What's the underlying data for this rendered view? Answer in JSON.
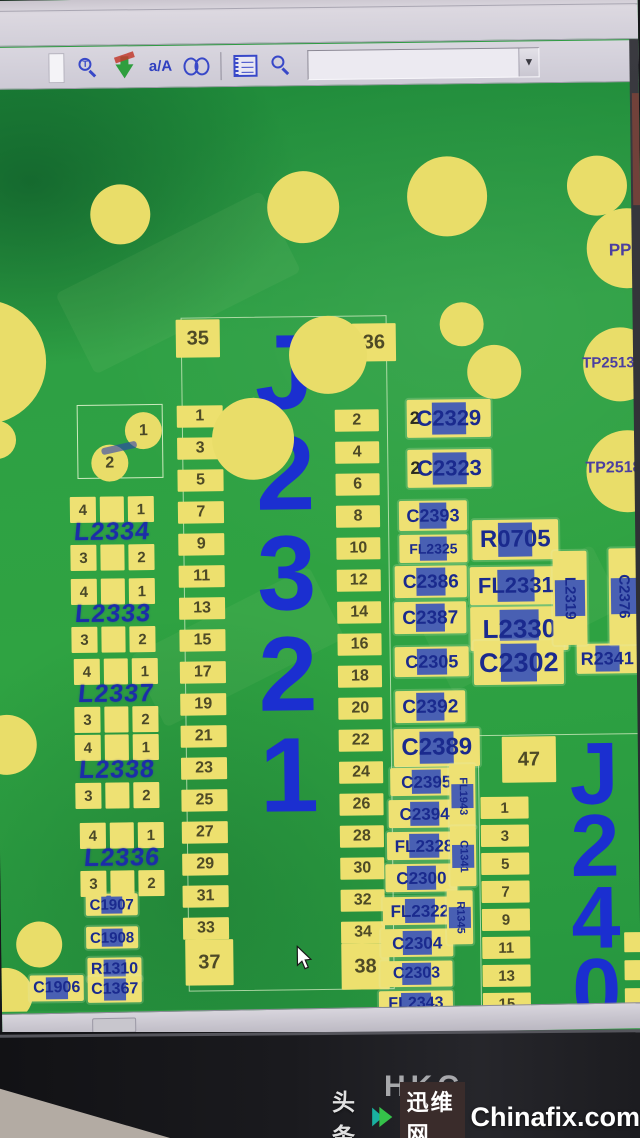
{
  "toolbar": {
    "case_label": "a/A",
    "zoom_glyph": "T",
    "combo_value": "",
    "dropdown_arrow": "▼",
    "icons": [
      "zoom-text",
      "sync-arrows",
      "case-toggle",
      "binoculars",
      "notebook",
      "zoom"
    ]
  },
  "board": {
    "test_points": [
      {
        "label": "PP",
        "x": 616,
        "y": 158,
        "fs": 17
      },
      {
        "label": "TP2513",
        "x": 588,
        "y": 272,
        "fs": 15
      },
      {
        "label": "TP2518",
        "x": 590,
        "y": 377,
        "fs": 16
      }
    ],
    "vias": [
      [
        128,
        126,
        30
      ],
      [
        311,
        121,
        36
      ],
      [
        455,
        112,
        40
      ],
      [
        605,
        103,
        30
      ],
      [
        634,
        166,
        40
      ],
      [
        626,
        282,
        37
      ],
      [
        632,
        389,
        41
      ],
      [
        -10,
        272,
        62
      ],
      [
        2,
        350,
        19
      ],
      [
        334,
        269,
        39
      ],
      [
        258,
        352,
        41
      ],
      [
        468,
        240,
        22
      ],
      [
        500,
        288,
        27
      ],
      [
        8,
        655,
        30
      ],
      [
        38,
        855,
        23
      ],
      [
        4,
        905,
        27
      ],
      [
        140,
        950,
        27
      ],
      [
        192,
        1000,
        23
      ]
    ],
    "cap_square": {
      "pins": [
        "1",
        "2"
      ]
    },
    "inductors": [
      {
        "ref": "L2334",
        "pins": [
          "4",
          "1",
          "3",
          "2"
        ],
        "x": 74,
        "y": 408
      },
      {
        "ref": "L2333",
        "pins": [
          "4",
          "1",
          "3",
          "2"
        ],
        "x": 74,
        "y": 490
      },
      {
        "ref": "L2337",
        "pins": [
          "4",
          "1",
          "3",
          "2"
        ],
        "x": 76,
        "y": 570
      },
      {
        "ref": "L2338",
        "pins": [
          "4",
          "1",
          "3",
          "2"
        ],
        "x": 76,
        "y": 646
      },
      {
        "ref": "L2336",
        "pins": [
          "4",
          "1",
          "3",
          "2"
        ],
        "x": 80,
        "y": 734
      }
    ],
    "parts": [
      {
        "label": "C1907",
        "x": 85,
        "y": 805,
        "w": 52,
        "h": 22,
        "fs": 15
      },
      {
        "label": "C1908",
        "x": 85,
        "y": 838,
        "w": 52,
        "h": 22,
        "fs": 15
      },
      {
        "label": "R1310",
        "x": 86,
        "y": 869,
        "w": 54,
        "h": 24,
        "fs": 16
      },
      {
        "label": "C1906",
        "x": 28,
        "y": 886,
        "w": 54,
        "h": 26,
        "fs": 16
      },
      {
        "label": "C1367",
        "x": 86,
        "y": 888,
        "w": 54,
        "h": 26,
        "fs": 16
      },
      {
        "label": "C2329",
        "x": 412,
        "y": 315,
        "w": 84,
        "h": 38,
        "fs": 22,
        "pin": "2"
      },
      {
        "label": "C2323",
        "x": 412,
        "y": 365,
        "w": 84,
        "h": 38,
        "fs": 22,
        "pin": "2"
      },
      {
        "label": "C2393",
        "x": 403,
        "y": 416,
        "w": 68,
        "h": 30,
        "fs": 18
      },
      {
        "label": "FL2325",
        "x": 403,
        "y": 450,
        "w": 68,
        "h": 28,
        "fs": 14
      },
      {
        "label": "R0705",
        "x": 476,
        "y": 436,
        "w": 86,
        "h": 40,
        "fs": 24
      },
      {
        "label": "C2386",
        "x": 398,
        "y": 481,
        "w": 72,
        "h": 32,
        "fs": 19
      },
      {
        "label": "FL2331",
        "x": 473,
        "y": 483,
        "w": 92,
        "h": 38,
        "fs": 22
      },
      {
        "label": "C2387",
        "x": 397,
        "y": 517,
        "w": 72,
        "h": 32,
        "fs": 19
      },
      {
        "label": "L2330",
        "x": 473,
        "y": 523,
        "w": 98,
        "h": 44,
        "fs": 26
      },
      {
        "label": "C2305",
        "x": 397,
        "y": 562,
        "w": 74,
        "h": 30,
        "fs": 18
      },
      {
        "label": "C2302",
        "x": 476,
        "y": 557,
        "w": 90,
        "h": 44,
        "fs": 27
      },
      {
        "label": "R2341",
        "x": 579,
        "y": 561,
        "w": 61,
        "h": 30,
        "fs": 18
      },
      {
        "label": "C2392",
        "x": 397,
        "y": 606,
        "w": 70,
        "h": 32,
        "fs": 19
      },
      {
        "label": "C2389",
        "x": 395,
        "y": 644,
        "w": 86,
        "h": 38,
        "fs": 24
      },
      {
        "label": "C2395",
        "x": 391,
        "y": 683,
        "w": 72,
        "h": 28,
        "fs": 17
      },
      {
        "label": "C2394",
        "x": 389,
        "y": 715,
        "w": 72,
        "h": 28,
        "fs": 17
      },
      {
        "label": "FL2328",
        "x": 387,
        "y": 747,
        "w": 74,
        "h": 28,
        "fs": 17
      },
      {
        "label": "C2300",
        "x": 385,
        "y": 779,
        "w": 72,
        "h": 28,
        "fs": 17
      },
      {
        "label": "FL2322",
        "x": 382,
        "y": 812,
        "w": 74,
        "h": 28,
        "fs": 17
      },
      {
        "label": "C2304",
        "x": 380,
        "y": 844,
        "w": 72,
        "h": 28,
        "fs": 17
      },
      {
        "label": "C2303",
        "x": 379,
        "y": 876,
        "w": 72,
        "h": 26,
        "fs": 16
      },
      {
        "label": "FL2343",
        "x": 377,
        "y": 906,
        "w": 74,
        "h": 26,
        "fs": 16
      },
      {
        "label": "C2363",
        "x": 374,
        "y": 938,
        "w": 86,
        "h": 34,
        "fs": 21
      },
      {
        "label": "L2319",
        "x": 556,
        "y": 468,
        "w": 34,
        "h": 94,
        "fs": 15,
        "dir": "v"
      },
      {
        "label": "C2376",
        "x": 612,
        "y": 466,
        "w": 30,
        "h": 96,
        "fs": 15,
        "dir": "v"
      },
      {
        "label": "FL1943",
        "x": 450,
        "y": 680,
        "w": 26,
        "h": 64,
        "fs": 11,
        "dir": "v"
      },
      {
        "label": "C1341",
        "x": 450,
        "y": 742,
        "w": 26,
        "h": 60,
        "fs": 11,
        "dir": "v"
      },
      {
        "label": "R1345",
        "x": 446,
        "y": 806,
        "w": 26,
        "h": 54,
        "fs": 11,
        "dir": "v"
      }
    ],
    "j2321": {
      "ref_chars": [
        "J",
        "2",
        "3",
        "2",
        "1"
      ],
      "top_pads": [
        "35",
        "36"
      ],
      "left_pins": [
        "1",
        "3",
        "5",
        "7",
        "9",
        "11",
        "13",
        "15",
        "17",
        "19",
        "21",
        "23",
        "25",
        "27",
        "29",
        "31",
        "33"
      ],
      "right_pins": [
        "2",
        "4",
        "6",
        "8",
        "10",
        "12",
        "14",
        "16",
        "18",
        "20",
        "22",
        "24",
        "26",
        "28",
        "30",
        "32",
        "34"
      ],
      "bottom_pads": [
        "37",
        "38"
      ]
    },
    "j2401": {
      "ref_chars": [
        "J",
        "2",
        "4",
        "0",
        "1"
      ],
      "top_pad": "47",
      "left_pins": [
        "1",
        "3",
        "5",
        "7",
        "9",
        "11",
        "13",
        "15",
        "17",
        "19",
        "21"
      ],
      "right_edge_pins": [
        "18",
        "20",
        "22"
      ]
    }
  },
  "bezel": {
    "brand": "HKC"
  },
  "watermark": {
    "prefix": "头条",
    "site_cn": "迅维网",
    "site_en": "Chinafix.com"
  }
}
